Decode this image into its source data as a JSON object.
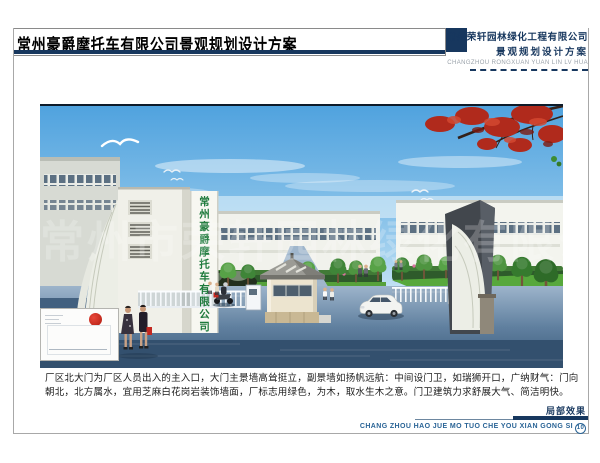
{
  "header": {
    "title": "常州豪爵摩托车有限公司景观规划设计方案",
    "company_name": "常州荣轩园林绿化工程有限公司",
    "company_subtitle": "景观规划设计方案",
    "company_pinyin": "CHANGZHOU RONGXUAN YUAN LIN LV HUA"
  },
  "rendering": {
    "gate_sign": "常州豪爵摩托车有限公司",
    "watermark": "常州市荣轩园林绿化有限公司"
  },
  "description": {
    "line1": "厂区北大门为厂区人员出入的主入口，大门主景墙高耸挺立，副景墙如扬帆远航：中间设门卫，如瑞狮开口，广纳财气：门向",
    "line2": "朝北，北方属水，宜用芝麻白花岗岩装饰墙面，厂标志用绿色，为木，取水生木之意。门卫建筑力求舒展大气、简洁明快。"
  },
  "footer": {
    "caption": "局部效果",
    "pinyin": "CHANG ZHOU HAO JUE MO TUO CHE YOU XIAN GONG SI",
    "page_number": "10"
  },
  "colors": {
    "accent_navy": "#17375e",
    "sign_green": "#1e7a3c",
    "maple_red": "#b02a1c"
  }
}
